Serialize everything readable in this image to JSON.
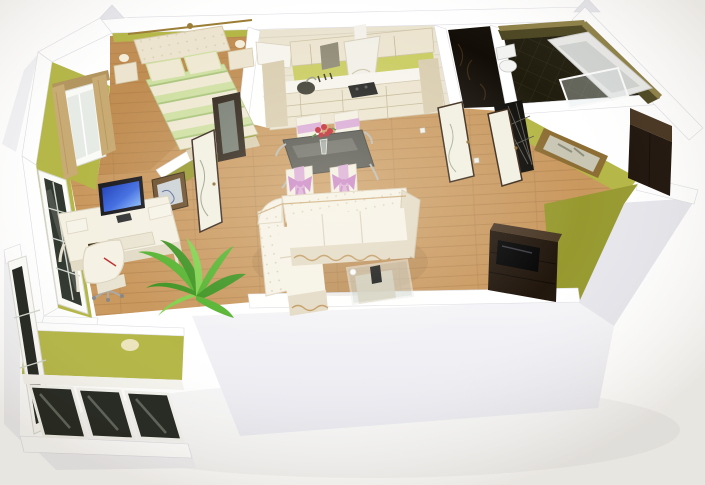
{
  "meta": {
    "title": "3D rendered apartment floor plan — isometric cutaway view with white walls, olive-green wallpaper and wood floors",
    "width": 705,
    "height": 485,
    "background": "#ffffff"
  },
  "colors": {
    "wallTopWhite": "#ffffff",
    "wallFace": "#f1f1f4",
    "wallFaceDark": "#e6e6ec",
    "wallGreen": "#b4b645",
    "wallGreenLight": "#c9cc5f",
    "wallGreenDark": "#97992f",
    "floorWood": "#c9985e",
    "floorWoodDark": "#a87a45",
    "floorBedroom": "#c08d52",
    "kitchenFloor": "#eae3d0",
    "bathFloor": "#1f1c0d",
    "bathWall": "#4a4420",
    "friezeGold": "#8d7f45",
    "cabinetCream": "#ece4cf",
    "cabinetCreamDark": "#d9cdaf",
    "counterWhite": "#f6f4ec",
    "sofaWhite": "#f6f2e6",
    "sofaShade": "#e3dac4",
    "sofaTrim": "#c0975c",
    "glassTable": "#50504a",
    "glassHighlight": "#76766e",
    "coffeeGlass": "#cfd4cd",
    "doorLeafCream": "#f2efe2",
    "doorFrameBrown": "#3a2817",
    "darkRoom": "#120d06",
    "wardrobeBrown": "#1d1209",
    "wardrobeTop": "#45321e",
    "tvUnitDark": "#22170d",
    "tvUnitTop": "#4a3826",
    "chairWhite": "#f3efe2",
    "ribbonPink": "#d9a8d6",
    "bowViolet": "#c77fc4",
    "roseRed": "#c2202d",
    "plantGreen": "#54b32e",
    "plantDark": "#3c9320",
    "plantLight": "#7fd14c",
    "screenBlue": "#2e57d8",
    "curtainTan": "#c8aa72",
    "curtainDark": "#b2935c",
    "bedCream": "#efe8d2",
    "bedStripeGreen": "#cfe0a2",
    "balconyGlass": "#20241e",
    "windowGlass": "#e7ebe6",
    "mirrorGold": "#8c6d33",
    "mirrorGlass": "#c9c6b4",
    "tuftDot": "#d8cdb0"
  },
  "scene": {
    "view": "isometric cutaway (doll-house) 3D render",
    "rooms": [
      {
        "id": "bedroom",
        "label": "Bedroom",
        "wall": "olive green",
        "furniture": [
          "double-bed",
          "tufted-headboard",
          "striped-duvet",
          "pillows",
          "nightstand-left",
          "nightstand-right",
          "table-lamps",
          "bay-window",
          "curtains",
          "canopy-rail",
          "mirror-wardrobe",
          "bedroom-door",
          "wall-picture"
        ]
      },
      {
        "id": "kitchen",
        "label": "Kitchen",
        "wall": "olive green",
        "furniture": [
          "upper-cabinets",
          "glass-cabinet",
          "range-hood",
          "cooktop",
          "sink",
          "base-cabinets",
          "corner-counter",
          "backsplash"
        ]
      },
      {
        "id": "dining",
        "label": "Dining area",
        "furniture": [
          "glass-dining-table",
          "dining-chair x4",
          "pink-ribbon-bows",
          "rose-bouquet"
        ]
      },
      {
        "id": "living",
        "label": "Living room",
        "furniture": [
          "white-corner-sofa",
          "glass-coffee-table",
          "remote-control",
          "tv-stand",
          "computer-desk",
          "monitor",
          "office-chair",
          "window-to-balcony",
          "palm-plant",
          "wall-picture"
        ]
      },
      {
        "id": "hallway",
        "label": "Hallway",
        "furniture": [
          "wc-door",
          "bathroom-door",
          "gold-framed-mirror",
          "dark-wardrobe",
          "power-outlets"
        ]
      },
      {
        "id": "bathroom",
        "label": "Bathroom",
        "wall": "dark olive tiles",
        "furniture": [
          "bathtub",
          "toilet",
          "glass-shower-screen",
          "gold-frieze"
        ]
      },
      {
        "id": "wc",
        "label": "WC",
        "furniture": [
          "dark-patterned-walls"
        ]
      },
      {
        "id": "balcony",
        "label": "Balcony",
        "furniture": [
          "glazed-window-panels",
          "parapet-wall",
          "sconce-light"
        ]
      }
    ]
  }
}
